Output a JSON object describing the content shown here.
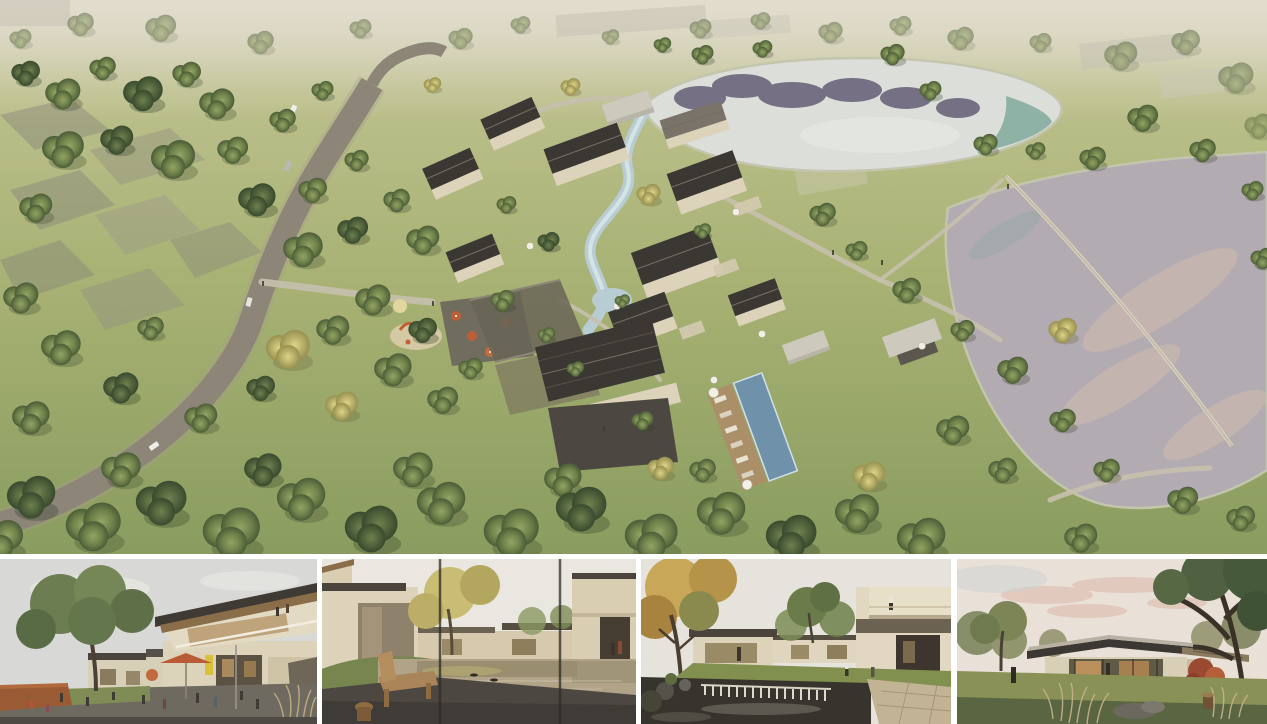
{
  "board": {
    "type": "architectural-rendering-presentation",
    "panel_count": 5,
    "background": "#ffffff",
    "gap_color": "#ffffff"
  },
  "panels": {
    "aerial": {
      "name": "aerial-masterplan-rendering",
      "description": "Bird's-eye rendering of a village resort: cluster of cream villas with dark gabled roofs around a winding stream, swimming pool with sun deck, curving asphalt road with cars through meadows and tree groves, playground and cafe terrace with orange umbrellas, two lakes at right reflecting sky, faded context buildings at the edges"
    },
    "thumbnails": [
      {
        "name": "courtyard-street-view",
        "description": "Ground-level view of a shopfront courtyard: large green tree at left, two-storey building with slanted timber-soffit roof at right, yellow shop sign, terracotta cafe umbrella, people seated at tables, corten planter and ornamental grasses"
      },
      {
        "name": "reflecting-pond-view",
        "description": "View through window mullions across a mirror-like reflecting pond between cream villas, golden tree, wooden bench and stool on a dark deck in the foreground, two people walking at right"
      },
      {
        "name": "garden-waterfall-view",
        "description": "Garden courtyard with dark pond and white stone weir in the foreground, autumn tree at left, cream cantilevered building with a person on the balcony at right, lawn with strolling people"
      },
      {
        "name": "glass-pavilion-view",
        "description": "Single-storey glass pavilion under a dark floating roof at dusk, pink-tinged clouds, red maple beside the building, large tree trunk at right, ornamental grasses and rocks on the lawn, one visitor at left"
      }
    ]
  },
  "palette": {
    "grass_light": "#bcc08c",
    "grass_mid": "#a8b274",
    "grass_dark": "#8a9c5f",
    "tree_green": "#64774a",
    "tree_dark": "#46573a",
    "tree_yellow": "#c9c177",
    "road_asphalt": "#8d8578",
    "path_beige": "#c6c0ad",
    "roof_dark": "#3b3733",
    "wall_cream": "#ddd3bb",
    "stone_dark": "#57534b",
    "deck_wood": "#ab8f69",
    "pond_pale": "#dcdeda",
    "reflection_purple": "#4e4663",
    "reflection_teal": "#4f8f7c",
    "lake_mauve": "#b3abb2",
    "lake_pink_sheen": "#d9bfae",
    "pool_blue": "#6f91aa",
    "umbrella_orange": "#bc5f35",
    "umbrella_white": "#f2efe6",
    "haze": "#d9d5c6",
    "sky_overcast": "#d8d9d6",
    "sky_warm": "#eae7e0",
    "sky_dusk": "#e9e0d8",
    "dusk_pink": "#dfc0b2"
  }
}
